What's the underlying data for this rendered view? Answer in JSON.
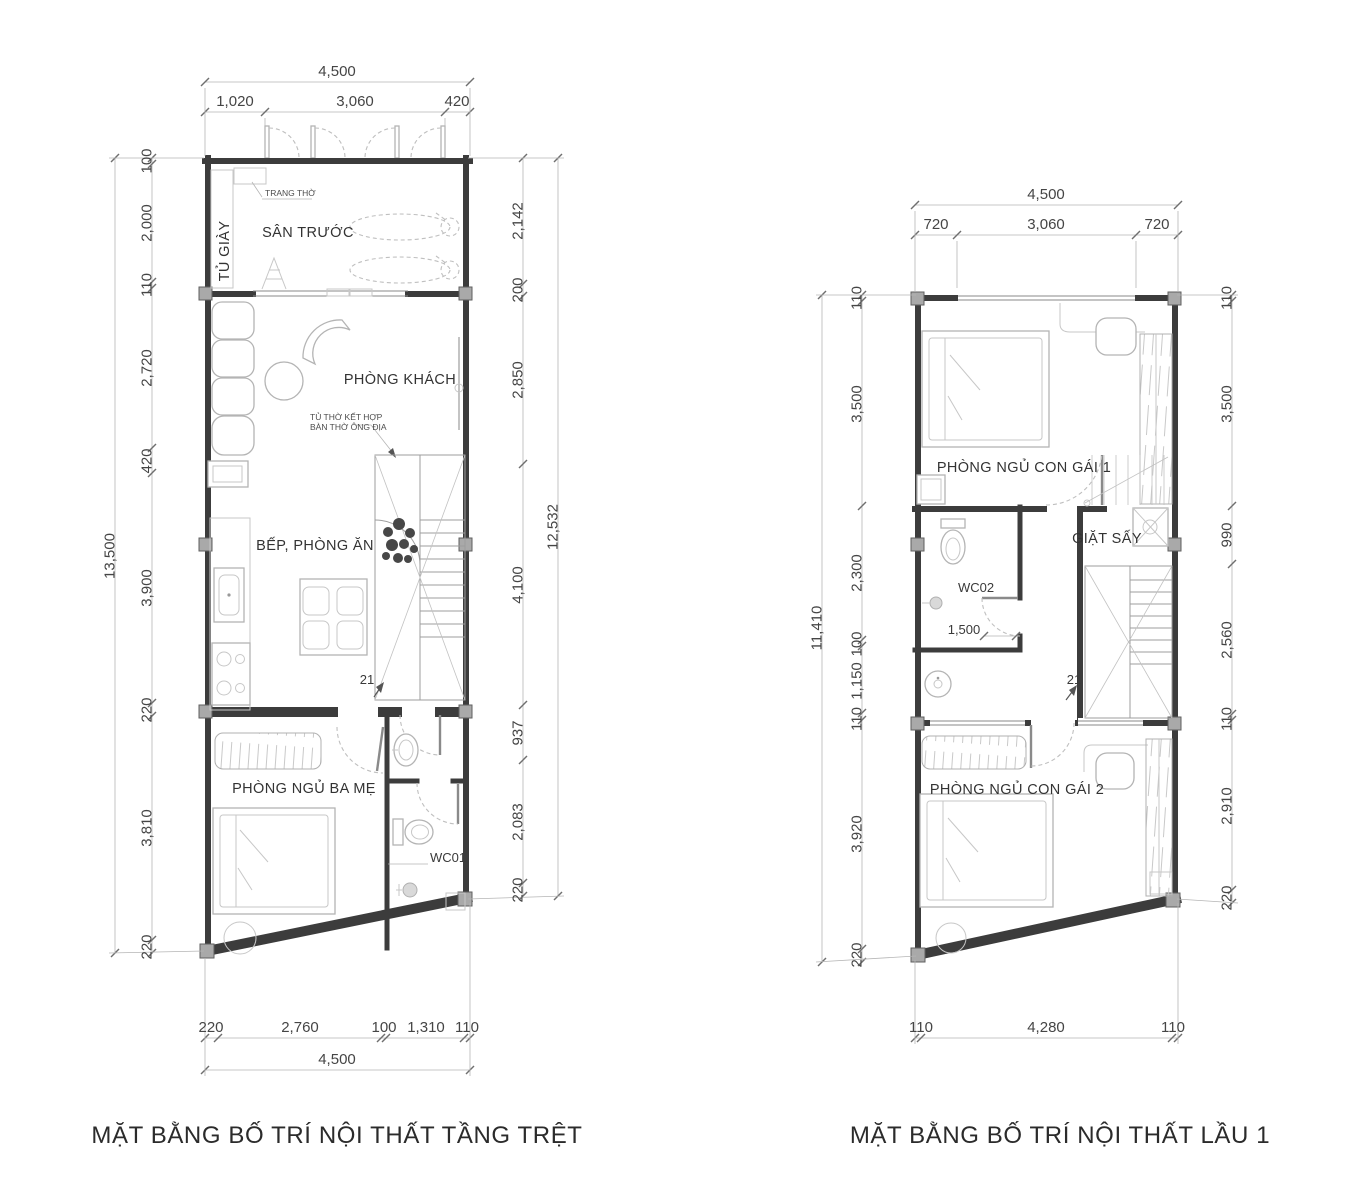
{
  "titles": {
    "ground": "MẶT BẰNG BỐ TRÍ NỘI THẤT TẦNG TRỆT",
    "first": "MẶT BẰNG BỐ TRÍ NỘI THẤT LẦU 1"
  },
  "colors": {
    "wall": "#3c3c3c",
    "dimension_text": "#454545",
    "furniture_line": "#b4b4b4"
  },
  "g": {
    "top": {
      "total": "4,500",
      "segs": [
        "1,020",
        "3,060",
        "420"
      ]
    },
    "bottom": {
      "total": "4,500",
      "segs": [
        "220",
        "2,760",
        "100",
        "1,310",
        "110"
      ]
    },
    "left": {
      "total": "13,500",
      "segs": [
        "100",
        "2,000",
        "110",
        "2,720",
        "420",
        "3,900",
        "220",
        "3,810",
        "220"
      ]
    },
    "right": {
      "total": "12,532",
      "segs": [
        "2,142",
        "200",
        "2,850",
        "4,100",
        "937",
        "2,083",
        "220"
      ]
    },
    "rooms": {
      "front_yard": "SÂN TRƯỚC",
      "living": "PHÒNG KHÁCH",
      "kitchen": "BẾP, PHÒNG ĂN",
      "master": "PHÒNG NGỦ BA MẸ",
      "wc": "WC01"
    },
    "notes": {
      "shoe_cabinet": "TỦ GIÀY",
      "altar_shelf": "TRANG THỜ",
      "altar_line1": "TỦ THỜ KẾT HỢP",
      "altar_line2": "BÀN THỜ ÔNG ĐỊA",
      "stair_step": "21"
    }
  },
  "f": {
    "top": {
      "total": "4,500",
      "segs": [
        "720",
        "3,060",
        "720"
      ]
    },
    "bottom": {
      "segs": [
        "110",
        "4,280",
        "110"
      ]
    },
    "left": {
      "total": "11,410",
      "segs": [
        "110",
        "3,500",
        "2,300",
        "100",
        "1,150",
        "110",
        "3,920",
        "220"
      ]
    },
    "right": {
      "segs": [
        "110",
        "3,500",
        "990",
        "2,560",
        "110",
        "2,910",
        "220"
      ]
    },
    "rooms": {
      "bedroom1": "PHÒNG NGỦ CON GÁI 1",
      "laundry": "GIẶT SẤY",
      "wc": "WC02",
      "bedroom2": "PHÒNG NGỦ CON GÁI 2"
    },
    "notes": {
      "wc_width": "1,500",
      "stair_step": "21"
    }
  }
}
